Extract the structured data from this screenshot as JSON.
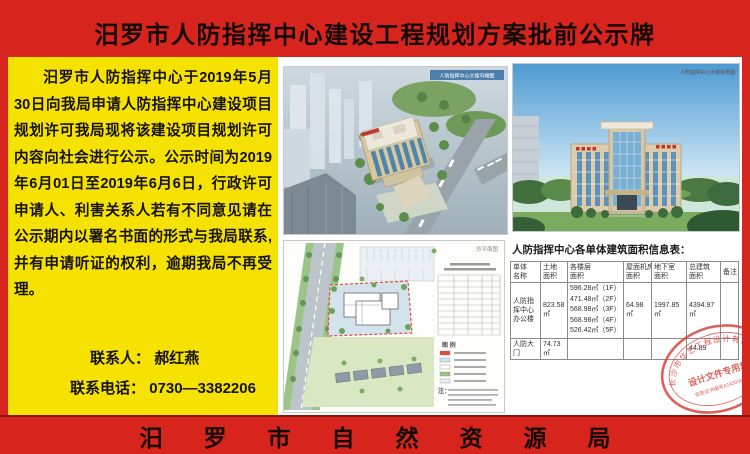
{
  "board": {
    "title": "汨罗市人防指挥中心建设工程规划方案批前公示牌",
    "footer": "汨罗市自然资源局"
  },
  "notice": {
    "body": "汨罗市人防指挥中心于2019年5月30日向我局申请人防指挥中心建设项目规划许可我局现将该建设项目规划许可内容向社会进行公示。公示时间为2019年6月01日至2019年6月6日，行政许可申请人、利害关系人若有不同意见请在公示期内以署名书面的形式与我局联系,并有申请听证的权利，逾期我局不再受理。",
    "contact_label": "联系人：",
    "contact_name": "郝红燕",
    "phone_label": "联系电话：",
    "phone": "0730—3382206"
  },
  "renders": {
    "aerial_caption": "人防指挥中心大楼鸟瞰图",
    "front_caption": "人防指挥中心大楼效果图"
  },
  "siteplan": {
    "caption": "总平面图",
    "legend_label": "图 例",
    "note_label": "注："
  },
  "area_table": {
    "title": "人防指挥中心各单体建筑面积信息表：",
    "headers": [
      [
        "单体",
        "名称"
      ],
      [
        "土地",
        "面积"
      ],
      [
        "各楼层",
        "面积"
      ],
      [
        "屋面机房",
        "面积"
      ],
      [
        "地下室",
        "面积"
      ],
      [
        "总建筑",
        "面积"
      ],
      [
        "备注",
        ""
      ]
    ],
    "rows": [
      {
        "name": "人防指挥中心办公楼",
        "land": "823.58㎡",
        "floors": [
          "596.28㎡（1F）",
          "471.48㎡（2F）",
          "568.98㎡（3F）",
          "568.98㎡（4F）",
          "526.42㎡（5F）"
        ],
        "roof": "64.98㎡",
        "basement": "1997.85㎡",
        "total": "4394.97㎡",
        "note": ""
      },
      {
        "name": "人防大门",
        "land": "74.73㎡",
        "roof": "",
        "basement": "",
        "total": "44.89",
        "note": ""
      }
    ]
  },
  "stamp": {
    "company": "长沙市华艺工程设计有限公司",
    "center": "设计文件专用章",
    "cert": "资质证书编号A143004066"
  }
}
